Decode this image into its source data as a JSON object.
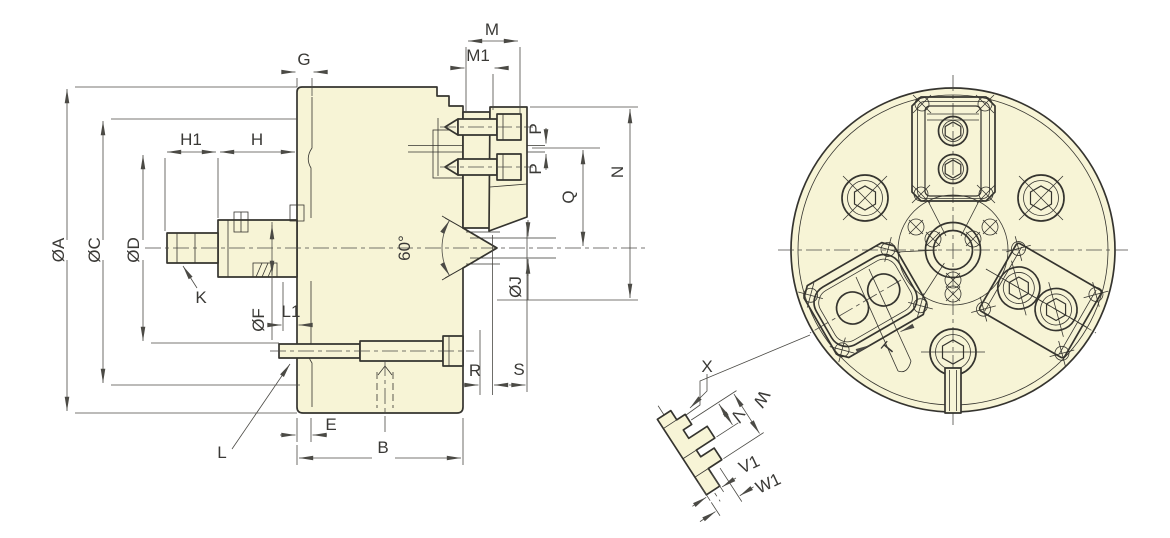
{
  "colors": {
    "body_fill": "#f7f4d6",
    "outline": "#35342f",
    "dim_line": "#4b4a45",
    "text_color": "#3a3936",
    "background": "#ffffff"
  },
  "side_view": {
    "labels": {
      "phi_a": "ØA",
      "phi_c": "ØC",
      "phi_d": "ØD",
      "phi_f": "ØF",
      "phi_j": "ØJ",
      "h1": "H1",
      "h": "H",
      "g": "G",
      "m": "M",
      "m1": "M1",
      "p_top": "P",
      "p_bottom": "P",
      "q": "Q",
      "n": "N",
      "k": "K",
      "l": "L",
      "l1": "L1",
      "e": "E",
      "b": "B",
      "r": "R",
      "s": "S",
      "angle": "60°"
    }
  },
  "front_view": {
    "labels": {
      "t": "T"
    }
  },
  "detail_view": {
    "labels": {
      "x": "X",
      "v": "V",
      "w": "W",
      "v1": "V1",
      "w1": "W1"
    }
  }
}
